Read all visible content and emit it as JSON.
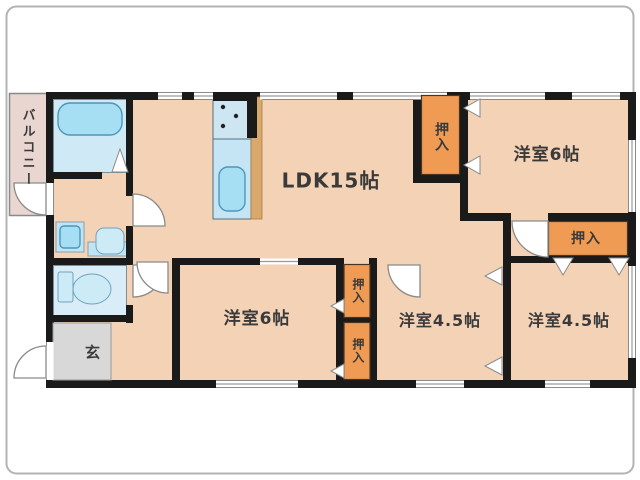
{
  "rooms": {
    "balcony": "バルコニー",
    "ldk": "LDK15帖",
    "bedroom_top_right": "洋室6帖",
    "bedroom_bottom_left": "洋室6帖",
    "bedroom_bottom_middle": "洋室4.5帖",
    "bedroom_bottom_right": "洋室4.5帖",
    "entrance": "玄"
  },
  "closets": [
    "押入",
    "押入",
    "押入",
    "押入"
  ],
  "colors": {
    "wall": "#1a1a1a",
    "floor": "#f3d2b6",
    "closet_orange": "#ef9b53",
    "bathroom_blue": "#cfe9f6",
    "toilet_blue": "#d9edf8",
    "fixture_blue": "#a6def4",
    "counter_blue": "#c6e5f4",
    "entrance_gray": "#d8d8d8",
    "balcony_pink": "#e9d6d0",
    "wood_strip": "#d9a86c",
    "label_text": "#3a3a3a"
  }
}
